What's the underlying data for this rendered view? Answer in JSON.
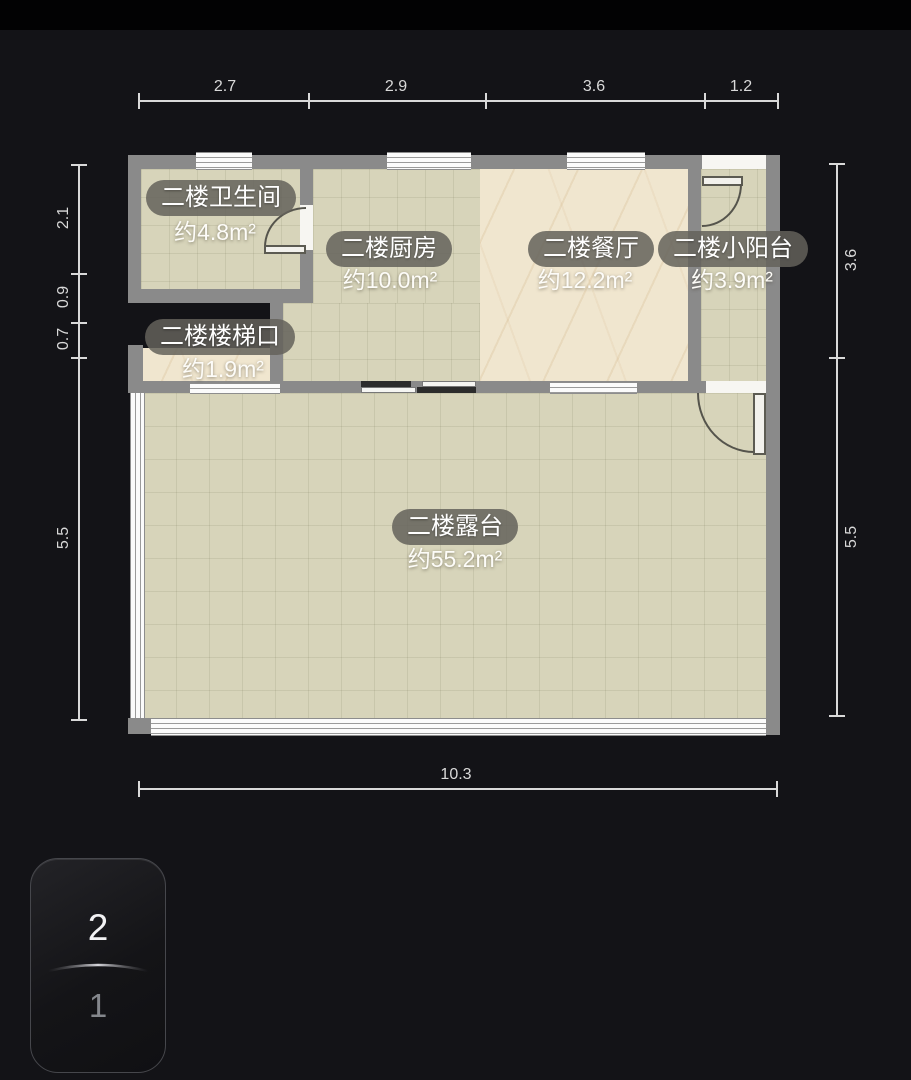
{
  "plan": {
    "rooms": [
      {
        "name": "二楼卫生间",
        "area": "约4.8m²"
      },
      {
        "name": "二楼厨房",
        "area": "约10.0m²"
      },
      {
        "name": "二楼餐厅",
        "area": "约12.2m²"
      },
      {
        "name": "二楼小阳台",
        "area": "约3.9m²"
      },
      {
        "name": "二楼楼梯口",
        "area": "约1.9m²"
      },
      {
        "name": "二楼露台",
        "area": "约55.2m²"
      }
    ]
  },
  "dims": {
    "top": [
      "2.7",
      "2.9",
      "3.6",
      "1.2"
    ],
    "left": [
      "2.1",
      "0.9",
      "0.7",
      "5.5"
    ],
    "right": [
      "3.6",
      "5.5"
    ],
    "bottom": [
      "10.3"
    ]
  },
  "floor_selector": {
    "current": "2",
    "other": "1"
  },
  "colors": {
    "wall": "#8a8a8a",
    "tile": "#d7d4ba",
    "marble": "#f0e6cf",
    "background": "#131317",
    "dimension": "#d9d9d9"
  }
}
